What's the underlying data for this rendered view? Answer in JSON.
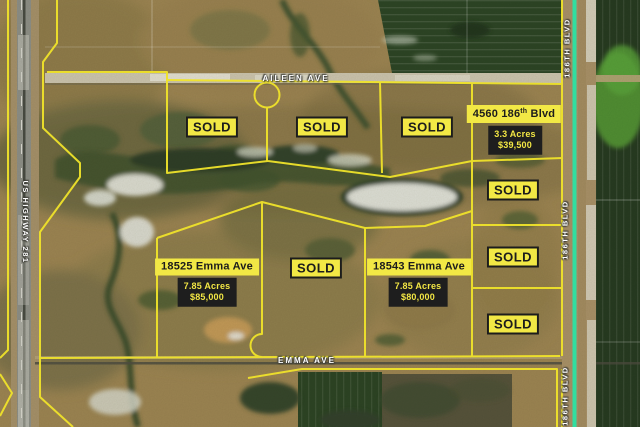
{
  "map": {
    "streets": {
      "aileen_ave": "AILEEN AVE",
      "emma_ave": "EMMA AVE",
      "us_highway_281": "US HIGHWAY 281",
      "blvd_186": "186TH BLVD"
    },
    "sold_label": "SOLD",
    "sold_parcels_count": 7,
    "listings": [
      {
        "address_prefix": "4560 186",
        "address_sup": "th",
        "address_suffix": " Blvd",
        "acres": "3.3 Acres",
        "price": "$39,500"
      },
      {
        "address_prefix": "18525 Emma Ave",
        "address_sup": "",
        "address_suffix": "",
        "acres": "7.85 Acres",
        "price": "$85,000"
      },
      {
        "address_prefix": "18543 Emma Ave",
        "address_sup": "",
        "address_suffix": "",
        "acres": "7.85 Acres",
        "price": "$80,000"
      }
    ],
    "colors": {
      "parcel_line": "#f0e32b",
      "label_bg": "#f2e845",
      "label_ink": "#1c1c1c",
      "price_bg": "#1e1e1e",
      "price_text": "#f2e644",
      "road_highlight": "#2be3a3",
      "road_label": "#ffffff"
    }
  }
}
